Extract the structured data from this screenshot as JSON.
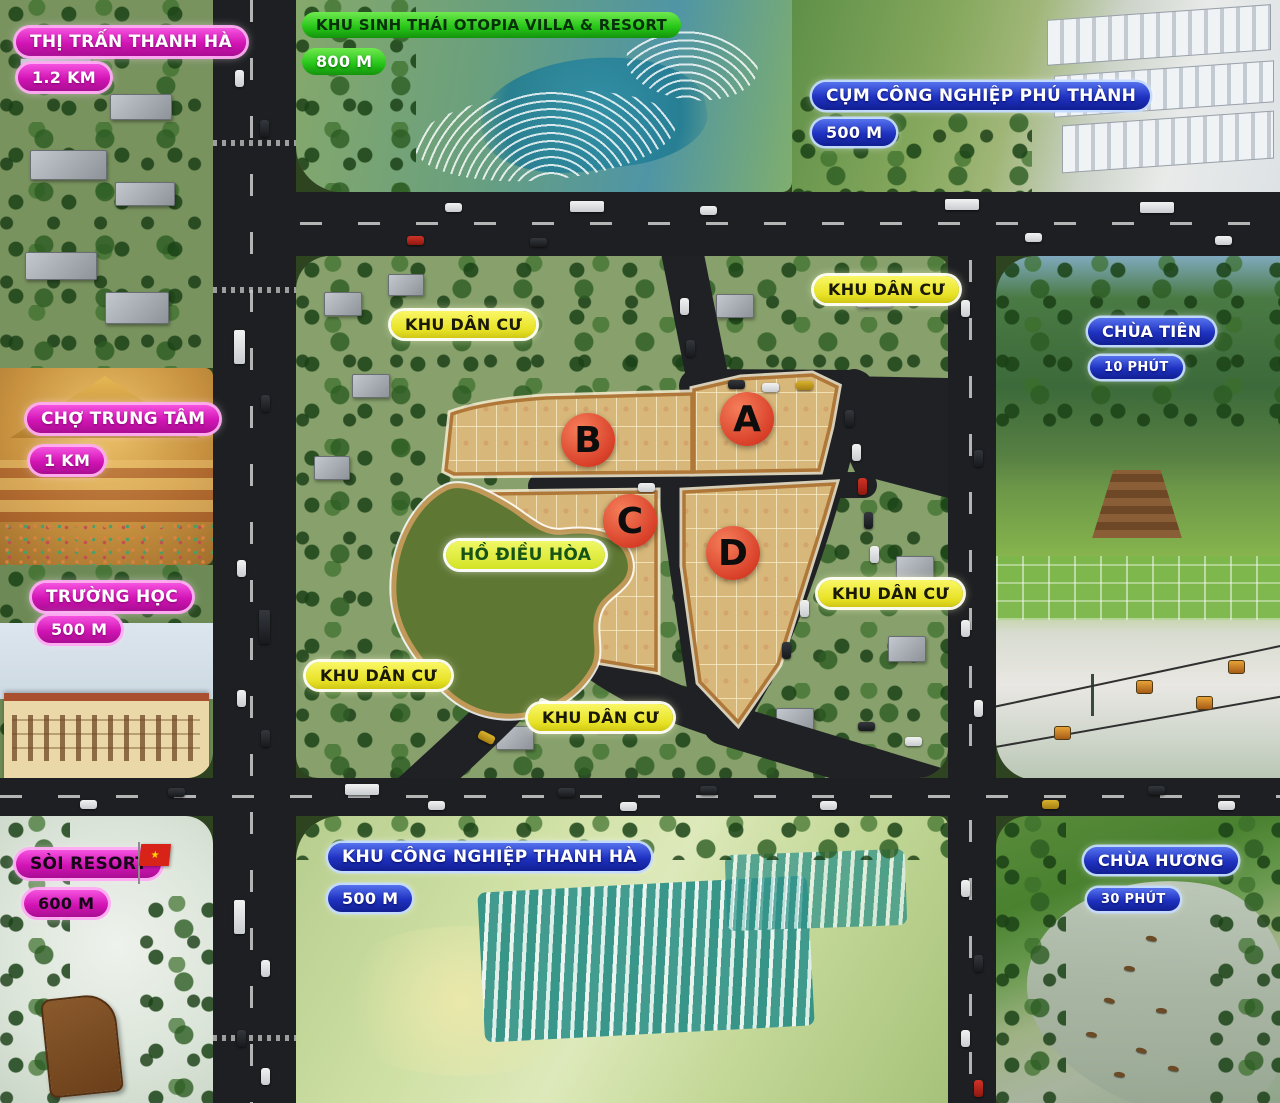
{
  "landmarks": {
    "thi_tran_thanh_ha": {
      "name": "THỊ TRẤN THANH HÀ",
      "distance": "1.2 KM"
    },
    "otopia_resort": {
      "name": "KHU SINH THÁI OTOPIA VILLA & RESORT",
      "distance": "800 M"
    },
    "cum_cn_phu_thanh": {
      "name": "CỤM CÔNG NGHIỆP PHÚ THÀNH",
      "distance": "500 M"
    },
    "cho_trung_tam": {
      "name": "CHỢ TRUNG TÂM",
      "distance": "1 KM"
    },
    "truong_hoc": {
      "name": "TRƯỜNG HỌC",
      "distance": "500 M"
    },
    "soi_resort": {
      "name": "SÒI RESORT",
      "distance": "600 M"
    },
    "chua_tien": {
      "name": "CHÙA TIÊN",
      "distance": "10 PHÚT"
    },
    "khu_cn_thanh_ha": {
      "name": "KHU CÔNG NGHIỆP THANH HÀ",
      "distance": "500 M"
    },
    "chua_huong": {
      "name": "CHÙA HƯƠNG",
      "distance": "30 PHÚT"
    }
  },
  "map": {
    "residential_label": "KHU DÂN CƯ",
    "lake_label": "HỒ ĐIỀU HÒA",
    "plot_zones": [
      "A",
      "B",
      "C",
      "D"
    ]
  },
  "colors": {
    "magenta_pill": "#d214b4",
    "green_pill": "#25c417",
    "blue_pill": "#1e31c0",
    "yellow_pill": "#e8e226",
    "lake_label_pill": "#d3e326",
    "plot_fill": "#d8b87a",
    "lake_fill": "#5e7733",
    "road": "#1d1f22",
    "plot_marker": "#d83f28"
  }
}
